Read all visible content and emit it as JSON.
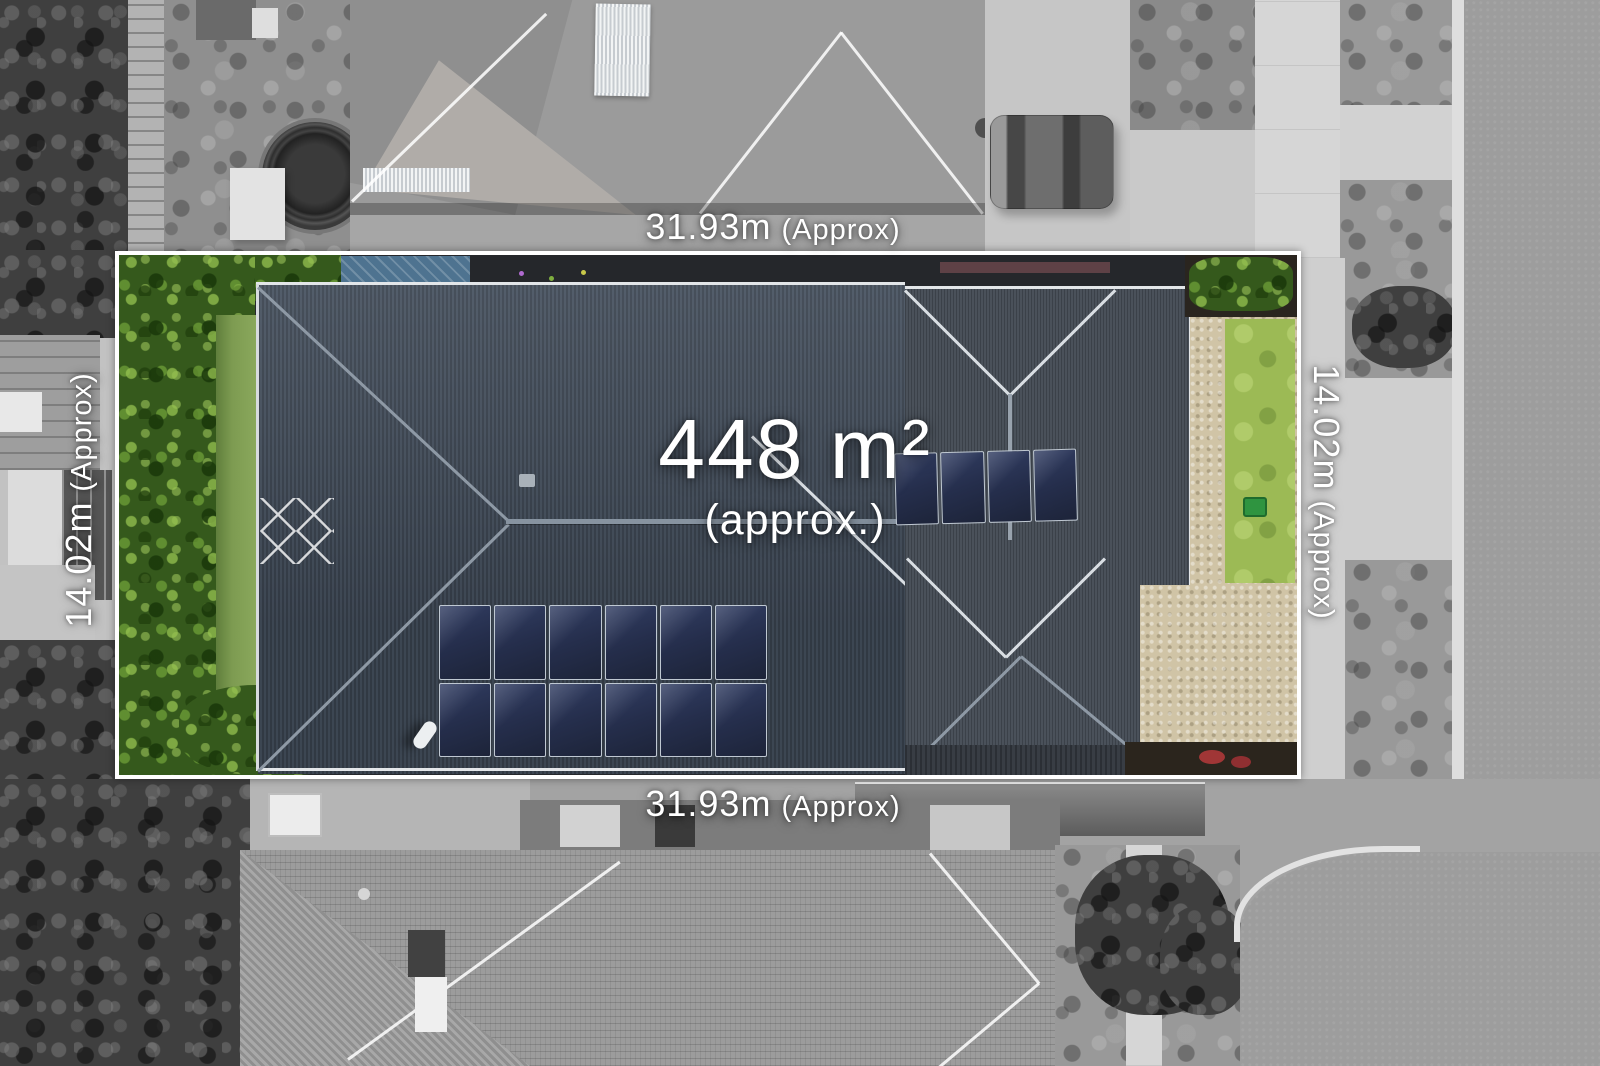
{
  "photo": {
    "description": "Aerial drone photo of a residential lot shown in colour inside a white boundary, surroundings in grayscale",
    "boundary_color": "#ffffff",
    "label_color": "#ffffff"
  },
  "labels": {
    "area": {
      "value": "448 m²",
      "qualifier": "(approx.)"
    },
    "frontage": {
      "value": "31.93m",
      "qualifier": "(Approx)"
    },
    "side": {
      "value": "14.02m",
      "qualifier": "(Approx)"
    }
  },
  "property": {
    "solar_panels_rear": 12,
    "solar_panels_front": 4,
    "colors": {
      "roof": "#3f4955",
      "roof_ridge": "#8e99a5",
      "solar_panel": "#242e4a",
      "hedge": "#35591c",
      "lawn": "#9cba55",
      "driveway_concrete": "#d0c4a6",
      "garden_mulch": "#2b251d",
      "road_gray": "#9d9d9d",
      "footpath_gray": "#d6d6d6"
    }
  }
}
